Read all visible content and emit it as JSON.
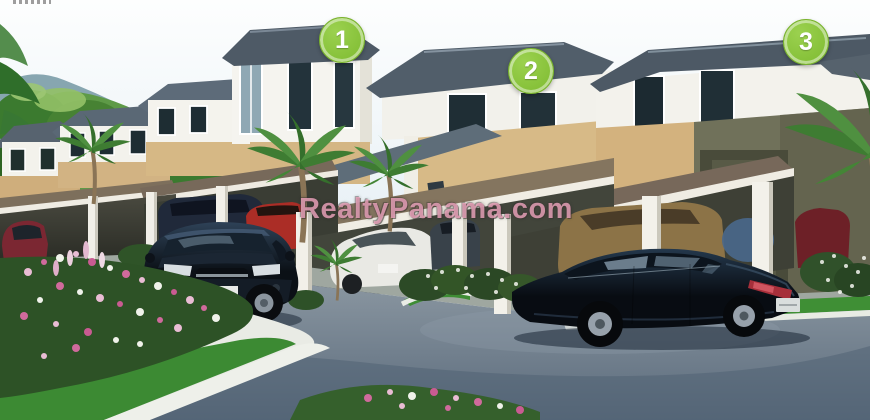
{
  "photo": {
    "description": "Architectural rendering of a row of two-story tan and white townhouses with brown carport roofs, parked cars, palm trees, flower beds and a curved blue-gray driveway, with green hills and mountains behind",
    "watermark": "RealtyPanama.com",
    "markers": [
      {
        "id": 1,
        "label": "1"
      },
      {
        "id": 2,
        "label": "2"
      },
      {
        "id": 3,
        "label": "3"
      }
    ]
  },
  "palette": {
    "marker_green": "#8cc63e",
    "watermark_pink": "#eba0b9",
    "wall_tan": "#d6b987",
    "wall_white": "#f3f2ec",
    "roof_slate": "#515e6a",
    "carport_brown": "#77685a",
    "asphalt_blue_gray": "#7b8896",
    "grass_green": "#3f8f35"
  }
}
